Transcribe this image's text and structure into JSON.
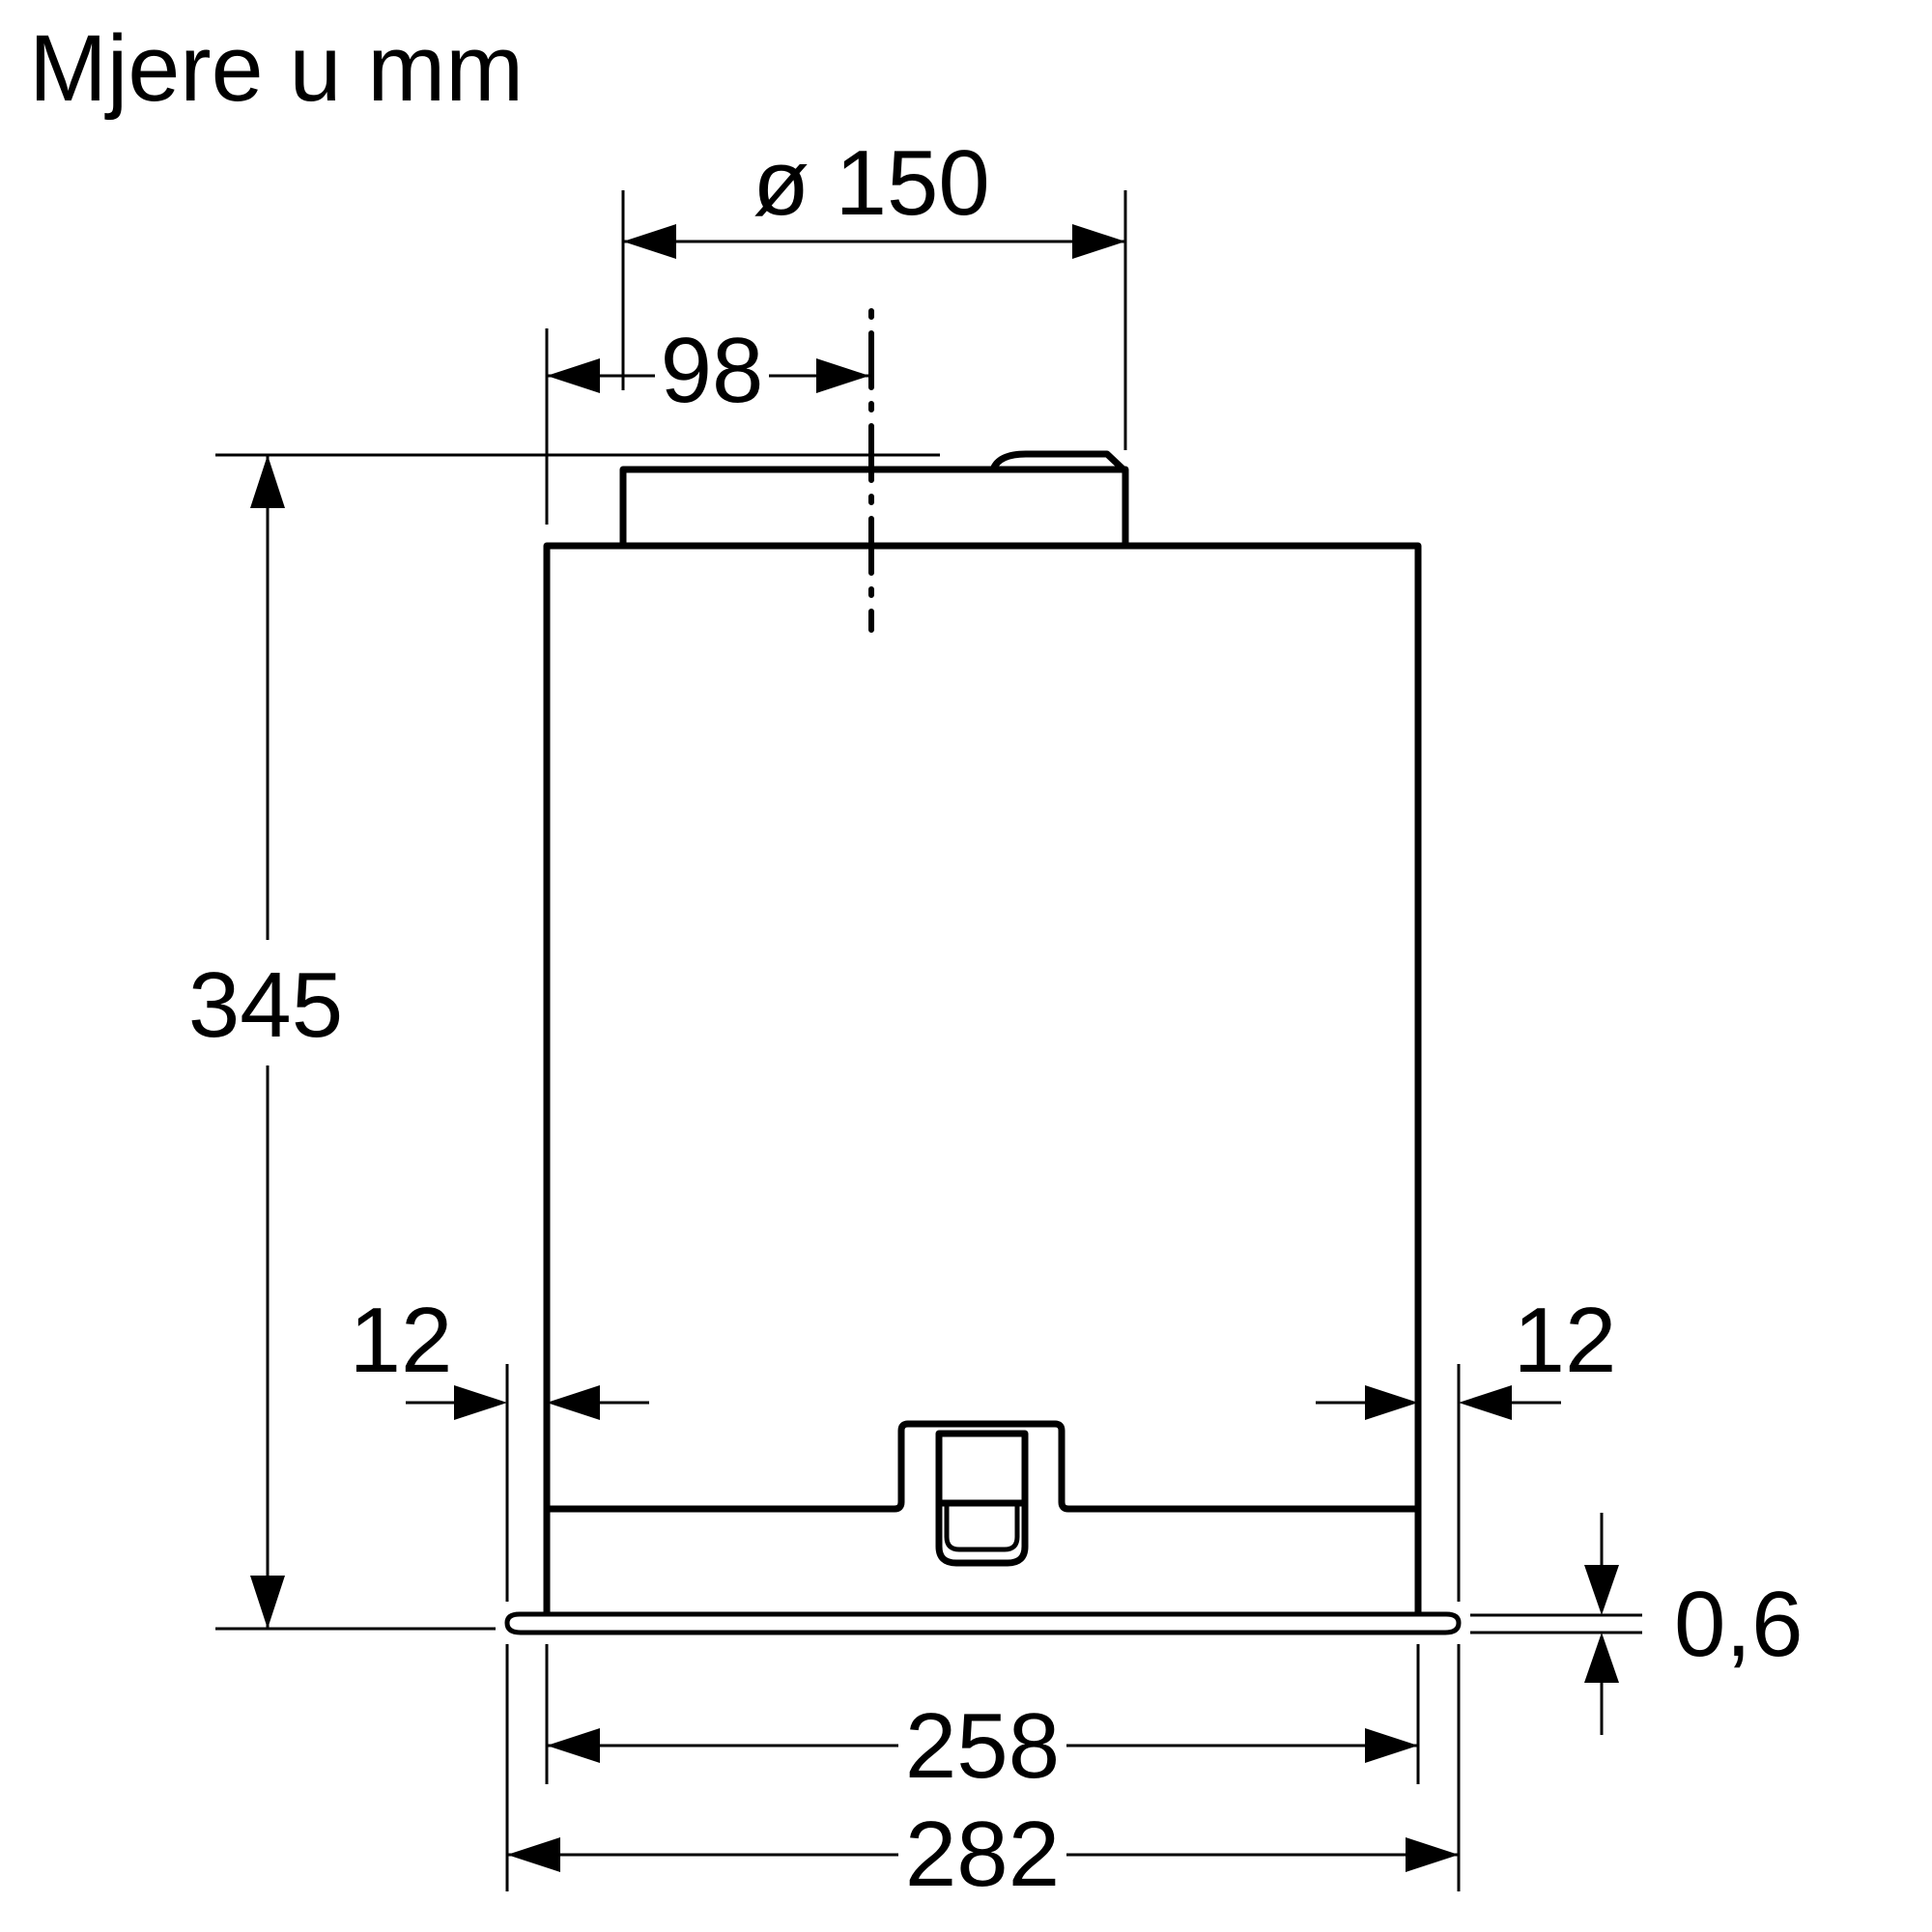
{
  "title": "Mjere u mm",
  "units": "mm",
  "colors": {
    "line": "#000000",
    "background": "#ffffff"
  },
  "dimensions": {
    "duct_diameter": {
      "label": "ø 150",
      "value_mm": 150,
      "description": "duct spigot diameter"
    },
    "duct_offset": {
      "label": "98",
      "value_mm": 98,
      "description": "duct centerline offset from left body edge"
    },
    "body_height": {
      "label": "345",
      "value_mm": 345,
      "description": "overall height from spigot top to flange bottom"
    },
    "overhang_left": {
      "label": "12",
      "value_mm": 12,
      "description": "flange overhang left"
    },
    "overhang_right": {
      "label": "12",
      "value_mm": 12,
      "description": "flange overhang right"
    },
    "flange_thickness": {
      "label": "0,6",
      "value_mm": 0.6,
      "description": "flange sheet thickness"
    },
    "body_width": {
      "label": "258",
      "value_mm": 258,
      "description": "body width"
    },
    "flange_width": {
      "label": "282",
      "value_mm": 282,
      "description": "flange width"
    }
  }
}
